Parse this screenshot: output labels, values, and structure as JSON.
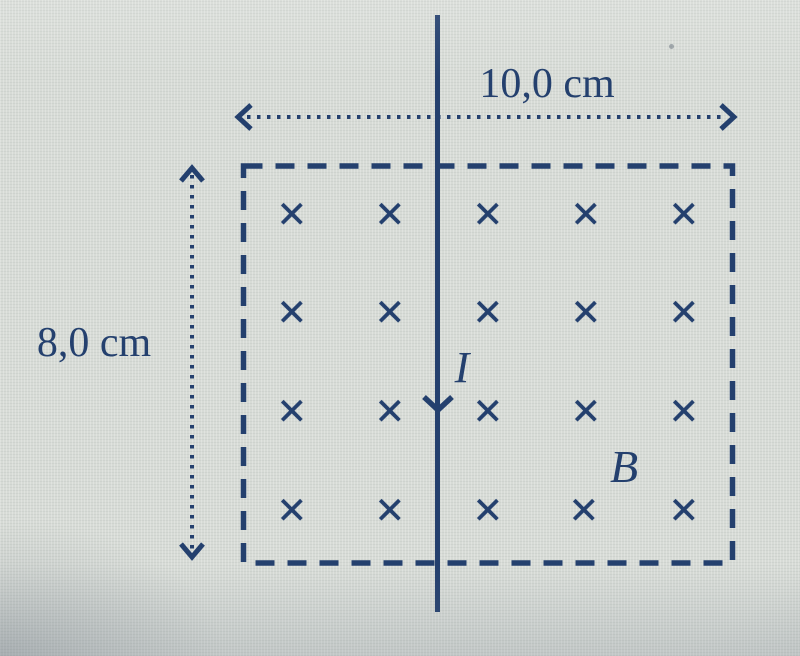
{
  "diagram": {
    "labels": {
      "width": "10,0 cm",
      "height": "8,0 cm",
      "current": "I",
      "field": "B"
    },
    "field": {
      "symbol": "×",
      "rows": 4,
      "columns": 5,
      "marks_total": 20
    },
    "colors": {
      "ink": "#24406e",
      "background": "#d7dbd6"
    }
  }
}
